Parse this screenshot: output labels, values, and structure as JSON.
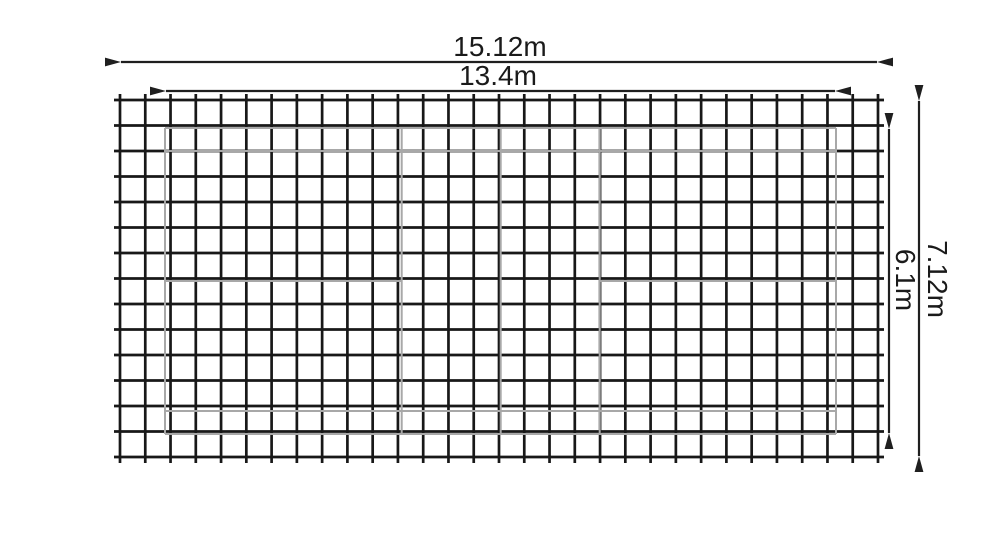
{
  "diagram": {
    "type": "dimensioned_mesh_court_drawing",
    "labels": {
      "outer_width": "15.12m",
      "inner_width": "13.4m",
      "outer_height": "7.12m",
      "inner_height": "6.1m"
    },
    "mesh": {
      "cols": 30,
      "rows": 14
    },
    "court": {
      "width_label": "13.4m",
      "height_label": "6.1m",
      "lines": [
        "boundary",
        "net-center",
        "short-service-left",
        "short-service-right",
        "center-line-left-half",
        "center-line-right-half",
        "singles-sideline-top",
        "singles-sideline-bottom"
      ]
    },
    "colors": {
      "grid": "#181818",
      "court": "#a8a8a8",
      "dimension": "#1f1f1f",
      "background": "#ffffff"
    }
  }
}
